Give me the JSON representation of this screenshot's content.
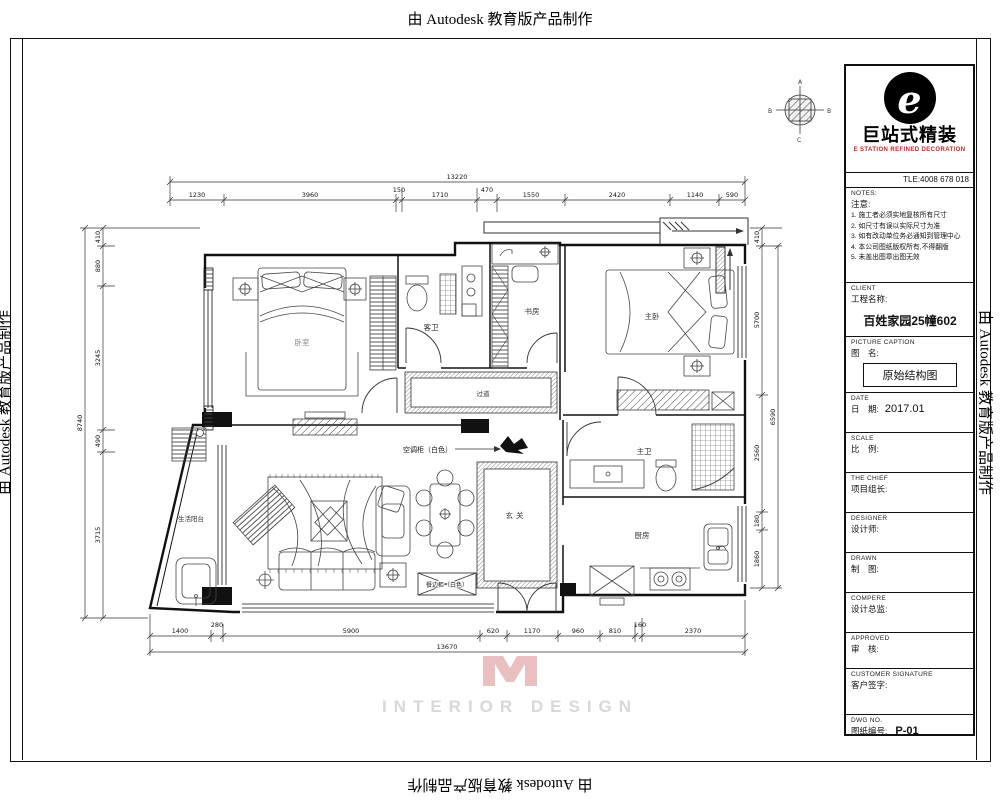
{
  "page": {
    "autodesk_stamp": "由 Autodesk 教育版产品制作"
  },
  "title_block": {
    "brand": {
      "logo_letter": "e",
      "cn": "巨站式精装",
      "en": "E STATION REFINED DECORATION",
      "tel": "TLE:4008 678 018"
    },
    "notes": {
      "en": "NOTES:",
      "cn": "注意:",
      "items": [
        "1. 施工者必须实地复核所有尺寸",
        "2. 如尺寸有误以实际尺寸为准",
        "3. 如有改动单位务必通知到管理中心",
        "4. 本公司图纸版权所有,不得翻版",
        "5. 未盖出图章出图无效"
      ]
    },
    "client": {
      "en": "CLIENT",
      "cn": "工程名称:",
      "value": "百姓家园25幢602"
    },
    "caption": {
      "en": "PICTURE CAPTION",
      "cn": "图　名:",
      "value": "原始结构图"
    },
    "date": {
      "en": "DATE",
      "cn": "日　期:",
      "value": "2017.01"
    },
    "scale": {
      "en": "SCALE",
      "cn": "比　例:",
      "value": ""
    },
    "chief": {
      "en": "THE CHIEF",
      "cn": "项目组长:",
      "value": ""
    },
    "designer": {
      "en": "DESIGNER",
      "cn": "设计师:",
      "value": ""
    },
    "drawn": {
      "en": "DRAWN",
      "cn": "制　图:",
      "value": ""
    },
    "compere": {
      "en": "COMPERE",
      "cn": "设计总监:",
      "value": ""
    },
    "approved": {
      "en": "APPROVED",
      "cn": "审　核:",
      "value": ""
    },
    "signature": {
      "en": "CUSTOMER SIGNATURE",
      "cn": "客户签字:",
      "value": ""
    },
    "dwg": {
      "en": "DWG  NO.",
      "cn": "图纸编号:",
      "value": "P-01"
    }
  },
  "plan": {
    "rooms": {
      "bedroom": "卧室",
      "guest_bath": "客卫",
      "study": "书房",
      "master": "主卧",
      "corridor": "过道",
      "entry": "玄关",
      "master_bath": "主卫",
      "kitchen": "厨房",
      "balcony": "生活阳台"
    },
    "annotations": {
      "ac_unit": "空调柜（白色）",
      "sideboard": "餐边柜（白色）"
    },
    "compass": {
      "top": "A",
      "left": "B",
      "right": "B",
      "bottom": "C"
    },
    "dims": {
      "top": {
        "total": "13220",
        "segments": [
          "1230",
          "3960",
          "150",
          "1710",
          "470",
          "1550",
          "2420",
          "1140",
          "590"
        ]
      },
      "bottom": {
        "total": "13670",
        "segments": [
          "1400",
          "280",
          "5900",
          "620",
          "1170",
          "960",
          "810",
          "160",
          "2370"
        ]
      },
      "left": {
        "total": "8740",
        "segments": [
          "410",
          "880",
          "3245",
          "490",
          "3715"
        ]
      },
      "right": {
        "total": "6590",
        "segments": [
          "410",
          "5700",
          "2560",
          "180",
          "1860"
        ]
      }
    }
  },
  "watermark": {
    "text": "INTERIOR DESIGN"
  }
}
